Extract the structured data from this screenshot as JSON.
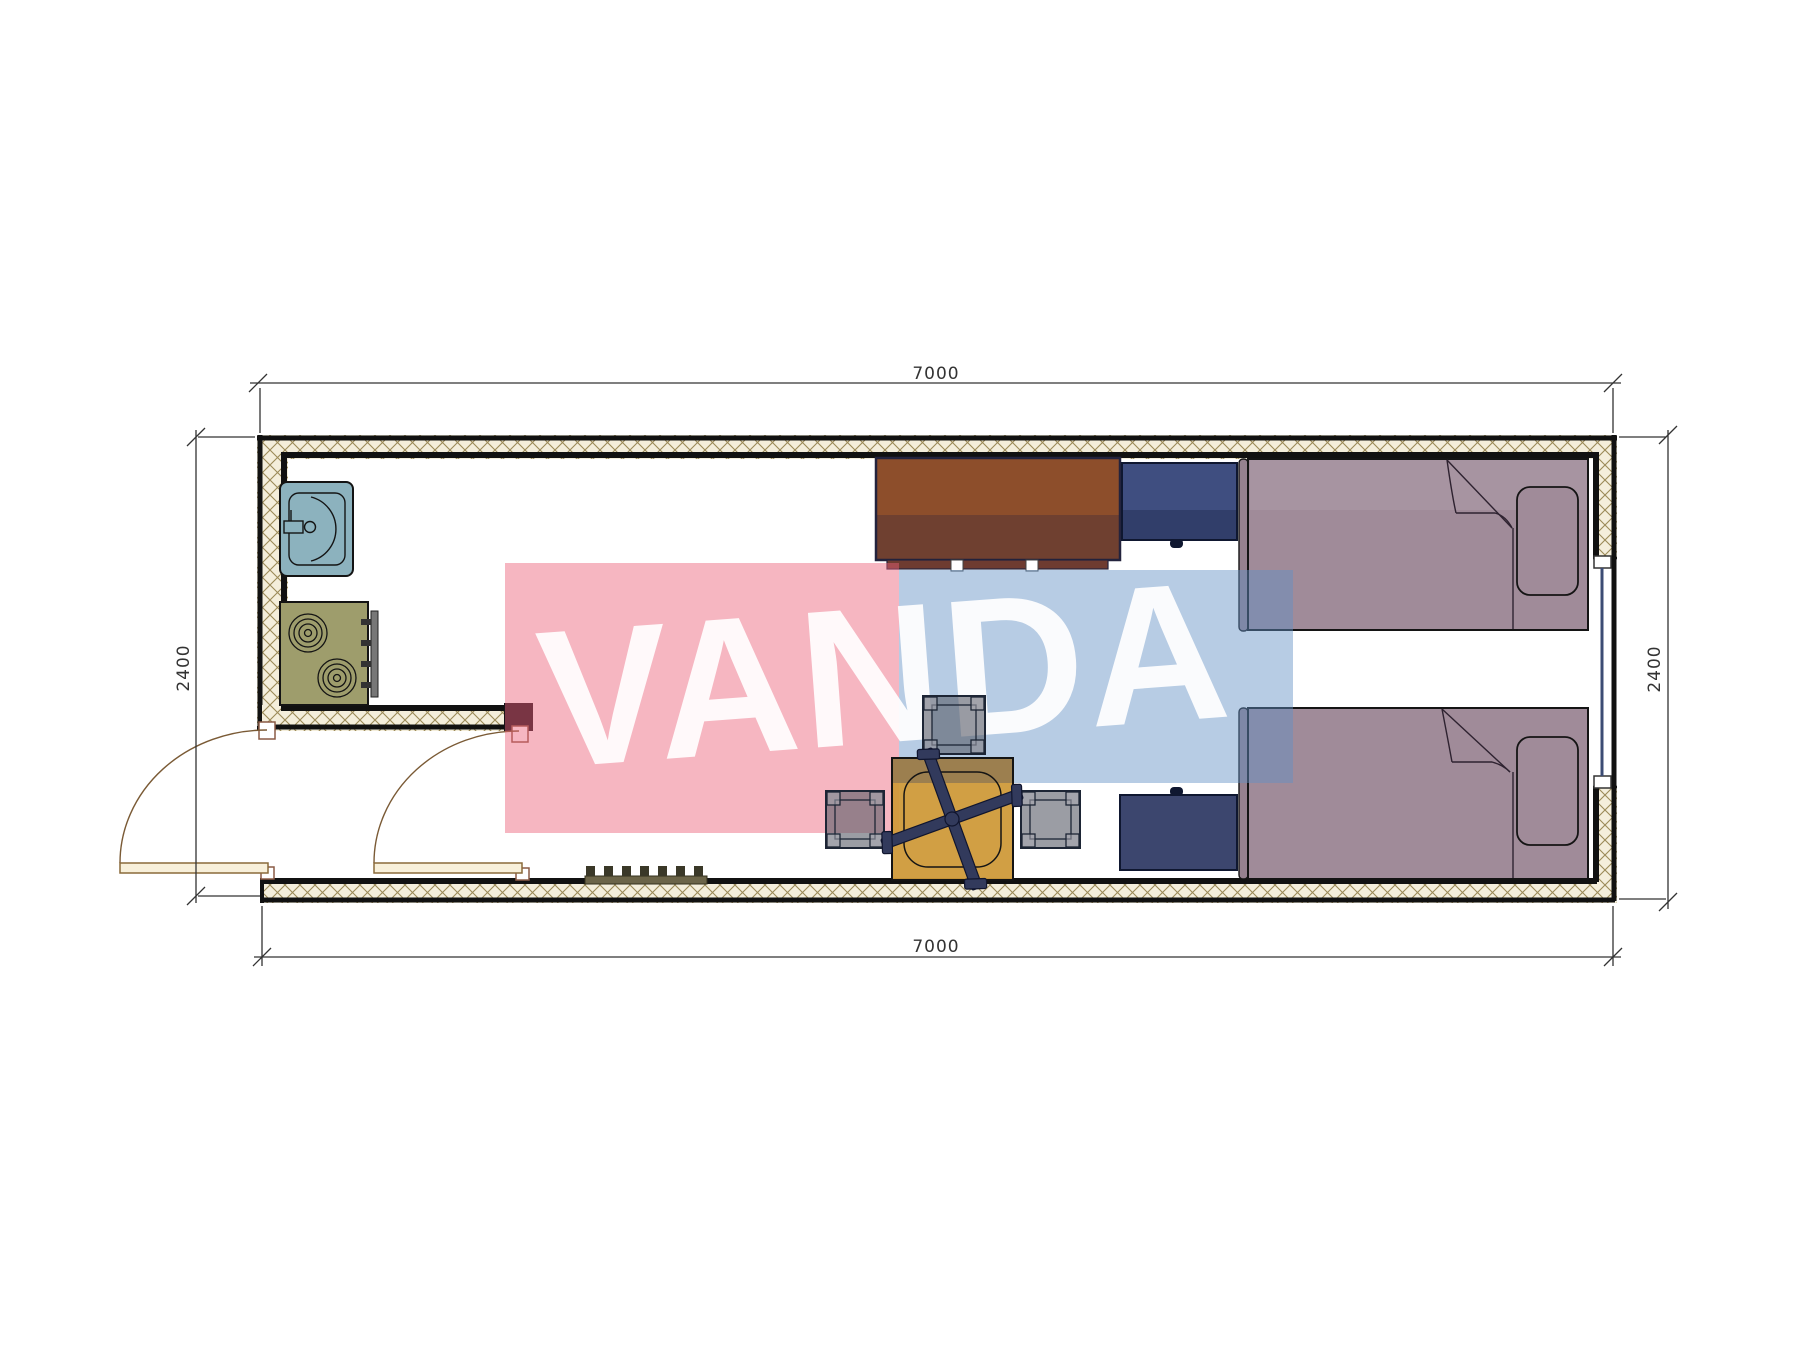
{
  "drawing": {
    "type": "architectural floor plan",
    "watermark": {
      "text": "VANDA"
    },
    "dimensions": {
      "top": "7000",
      "bottom": "7000",
      "left": "2400",
      "right": "2400"
    }
  },
  "colors": {
    "watermark_pink": "#eb5f78",
    "watermark_blue": "#6290c4",
    "watermark_text": "#ffffff",
    "wall_hatch_bg": "#f4eedb",
    "wall_hatch_line": "#9b8a58",
    "wall_line": "#111111",
    "sink": "#8cb2be",
    "stove": "#9e9d6c",
    "stove_panel": "#777777",
    "desk": "#8d4e2b",
    "desk_front": "#6e3b30",
    "cabinet": "#3f4e80",
    "chest": "#3c466e",
    "bed": "#a08b99",
    "headboard": "#96818f",
    "table": "#cf9a3a",
    "cross": "#323a5c",
    "stool": "#5a5e68",
    "door_leaf": "#f8f0da",
    "door_arc": "#7a5a35",
    "grate": "#6b6448",
    "window": "#3c4c74",
    "dimension": "#333333"
  },
  "items": [
    "exterior-walls",
    "interior-partition-wall",
    "window",
    "entry-door-left",
    "entry-door-right",
    "sink",
    "stove",
    "desk",
    "desk-chairs",
    "nightstand",
    "storage-chest",
    "bed-top",
    "bed-bottom",
    "coffee-table",
    "chair-cross-base",
    "stool-top",
    "stool-left",
    "stool-right",
    "floor-grate",
    "watermark-pink-block",
    "watermark-blue-block",
    "watermark-text"
  ]
}
